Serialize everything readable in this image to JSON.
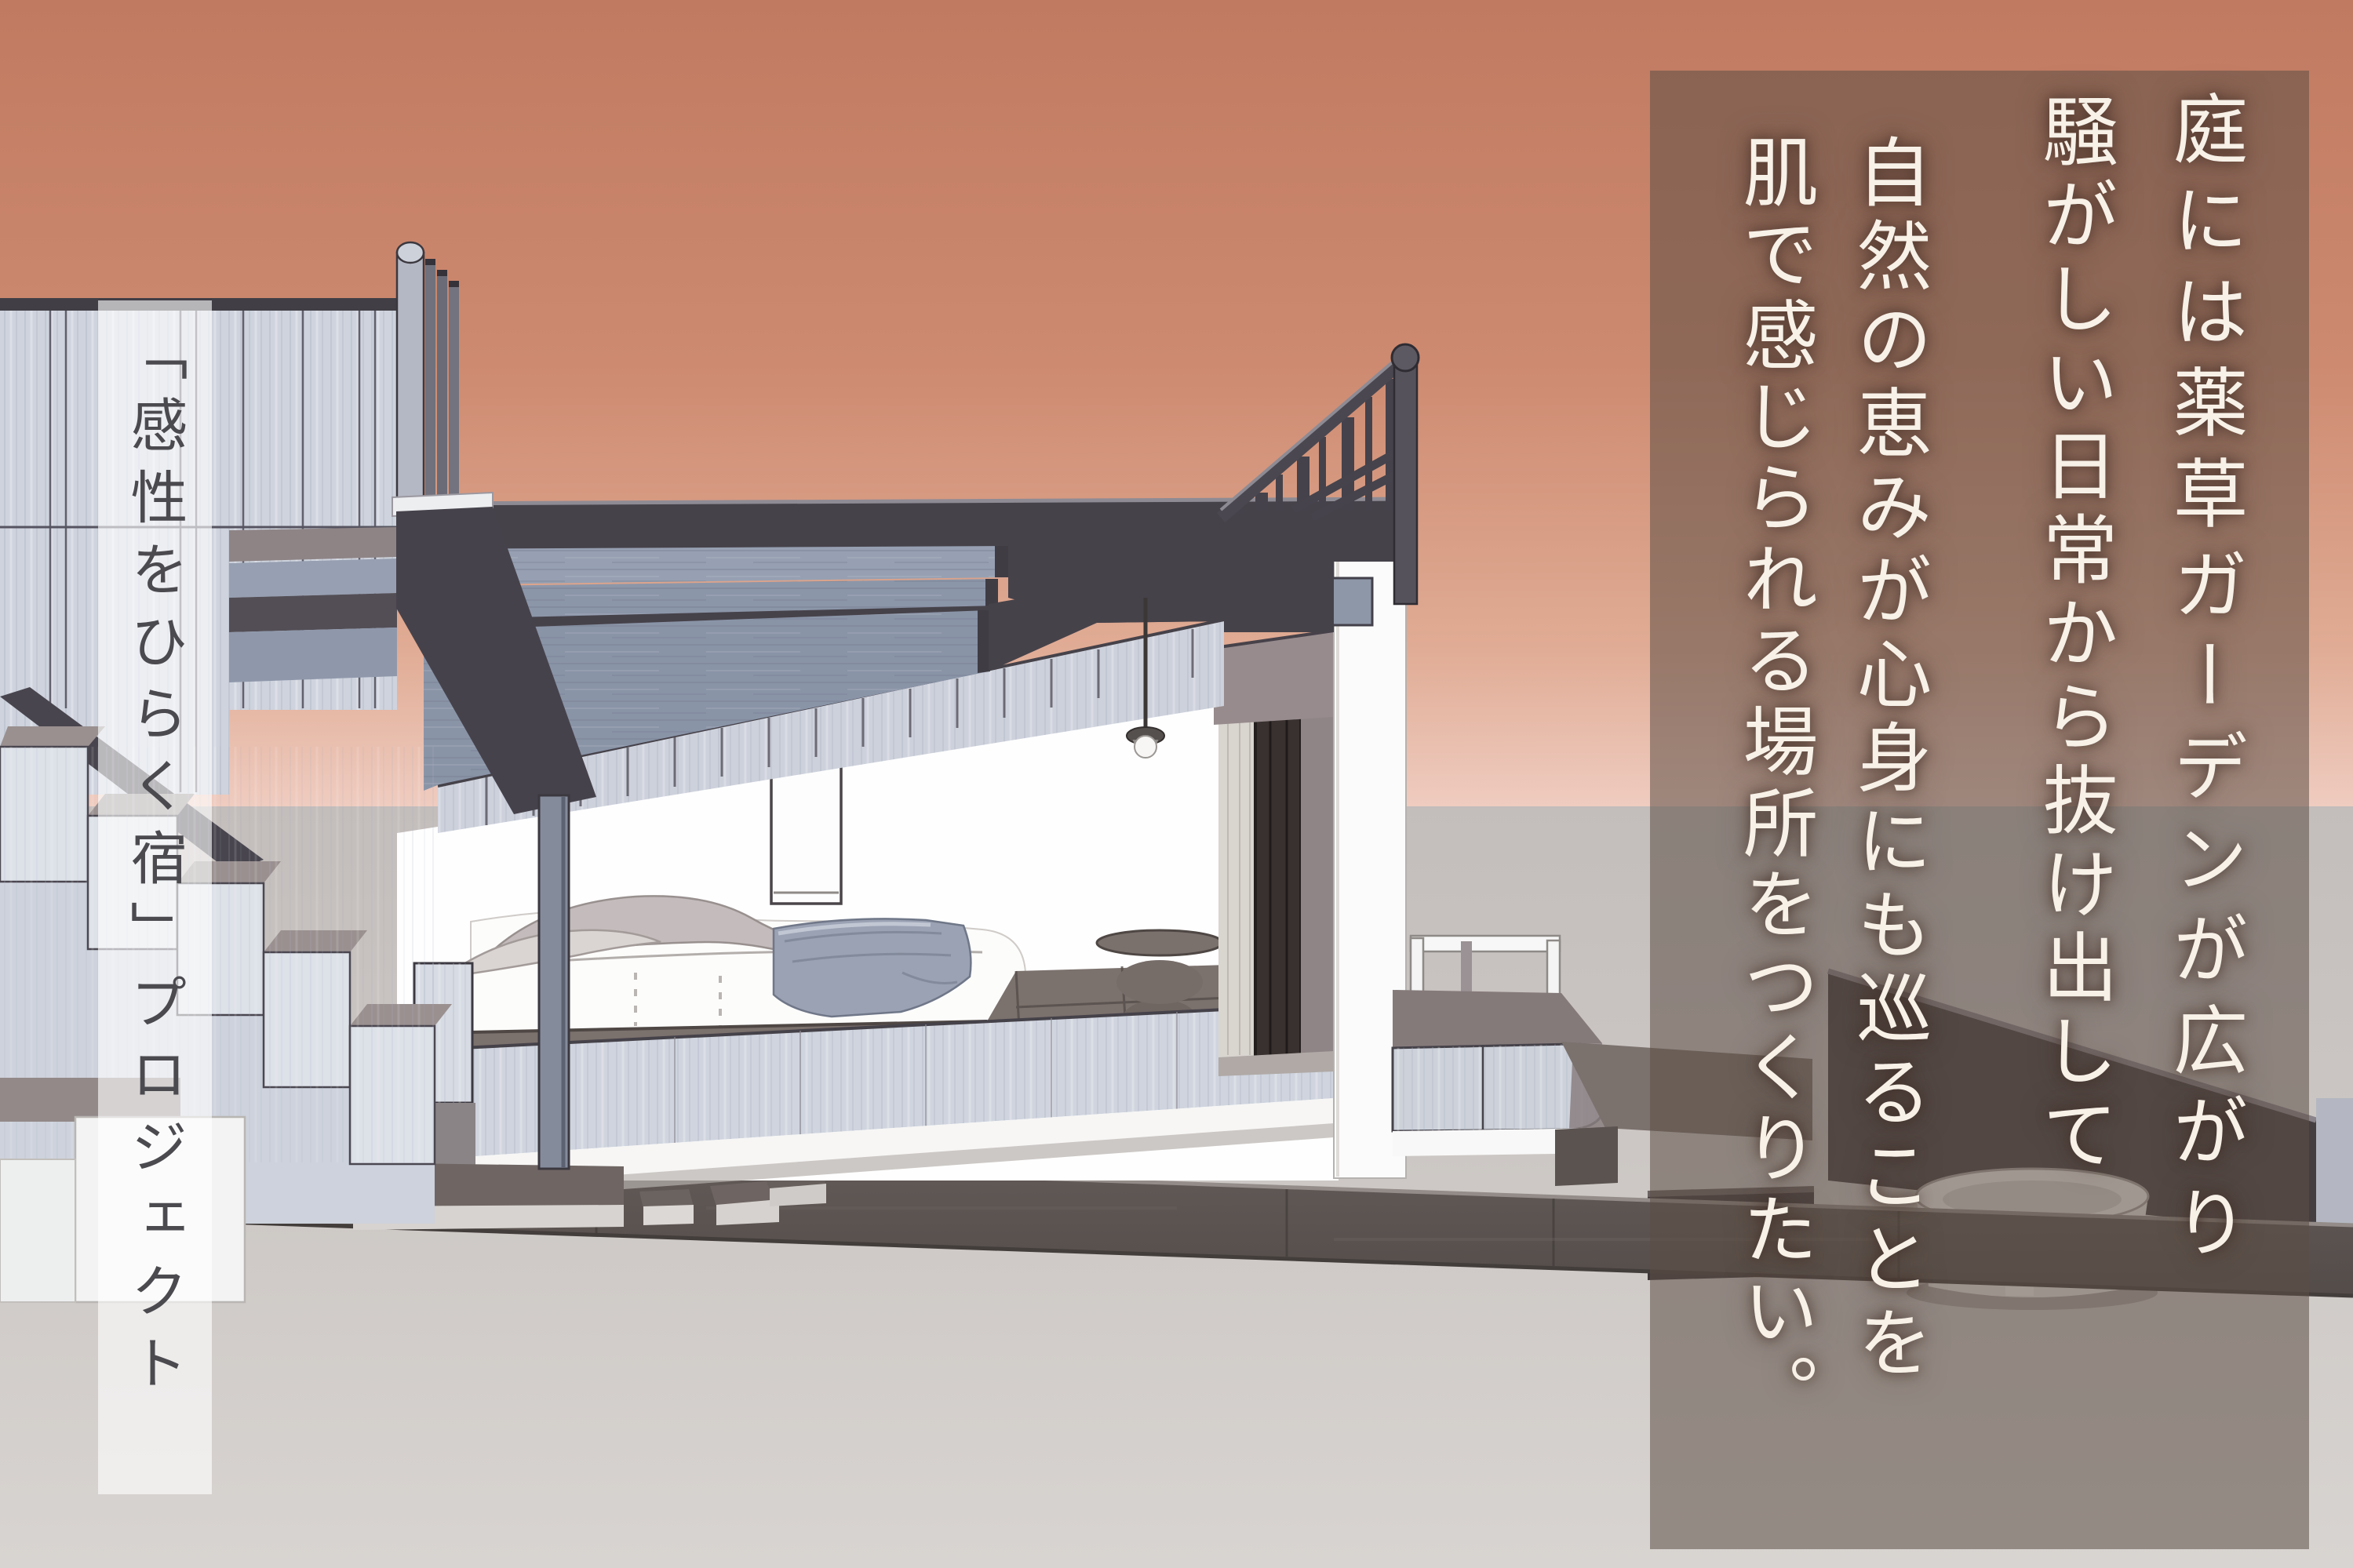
{
  "left_strip": {
    "text": "「感性をひらく宿」プロジェクト",
    "text_color": "#4b4a4f",
    "background": "rgba(255,255,255,0.62)"
  },
  "right_panel": {
    "background": "rgba(92,78,70,0.55)",
    "text_color": "#f7f1e8",
    "columns": [
      "庭には薬草ガーデンが広がり",
      "騒がしい日常から抜け出して",
      "自然の恵みが心身にも巡ることを",
      "肌で感じられる場所をつくりたい。"
    ]
  },
  "palette": {
    "sky_top": "#c07a61",
    "sky_horizon": "#efccc0",
    "ground": "#cac4c1",
    "walkway_dark": "#5e5653",
    "roof_dark": "#46424a",
    "beam_blue_gray": "#96a0b2",
    "plank_light": "#cfd4de",
    "tatami": "#7b716d",
    "taupe_wall": "#968a8c",
    "white_surface": "#fdfdfd"
  },
  "scene": {
    "description": "3D architectural sunset render: open bedroom pavilion with layered pergola roof, rooftop railing, plank fence, stepped stair volumes, low bed with pillows and blanket, pendant lamp, stone pedestal table, deck bench, stepping stones and round soaking tub"
  }
}
